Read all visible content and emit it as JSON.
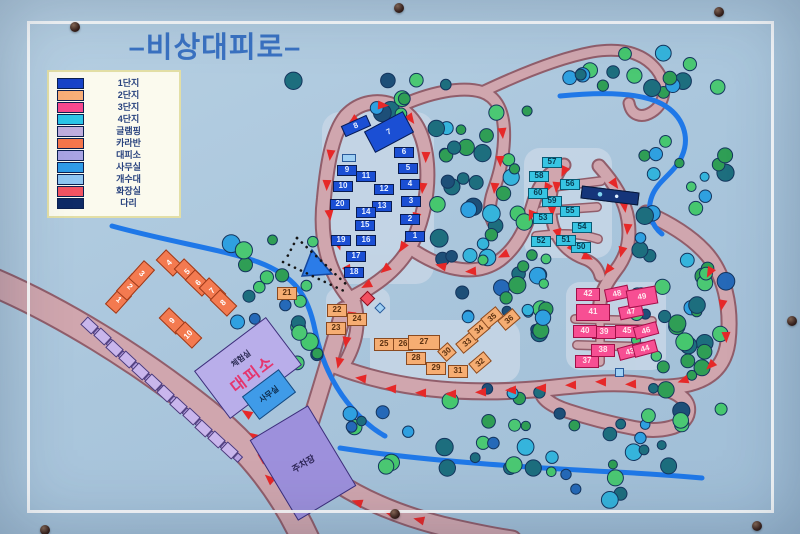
{
  "sign": {
    "title": "–비상대피로–"
  },
  "legend": {
    "items": [
      {
        "label": "1단지",
        "color": "#1843c8"
      },
      {
        "label": "2단지",
        "color": "#f9ae78"
      },
      {
        "label": "3단지",
        "color": "#f8488e"
      },
      {
        "label": "4단지",
        "color": "#2cc5e8"
      },
      {
        "label": "글램핑",
        "color": "#c0aede"
      },
      {
        "label": "카라반",
        "color": "#f5764c"
      },
      {
        "label": "대피소",
        "color": "#a9a4e4"
      },
      {
        "label": "사무실",
        "color": "#2f9ce8"
      },
      {
        "label": "개수대",
        "color": "#8fc6f2"
      },
      {
        "label": "화장실",
        "color": "#f25462"
      },
      {
        "label": "다리",
        "color": "#0e2a66"
      }
    ]
  },
  "map": {
    "facilities": {
      "shelter": {
        "room_label": "체험실",
        "label": "대피소"
      },
      "office": {
        "label": "사무실"
      },
      "parking": {
        "label": "주차장"
      }
    },
    "glamping": {
      "count": 12
    },
    "zones": [
      {
        "id": "z1",
        "legend_label": "1단지",
        "fill": "#1b4fd4",
        "text_color": "#e8f0ff",
        "border": "#0a1c50",
        "bw": 20,
        "bh": 11,
        "buildings": [
          {
            "n": 1,
            "x": 415,
            "y": 236
          },
          {
            "n": 2,
            "x": 410,
            "y": 219
          },
          {
            "n": 3,
            "x": 411,
            "y": 201
          },
          {
            "n": 4,
            "x": 410,
            "y": 184
          },
          {
            "n": 5,
            "x": 408,
            "y": 168
          },
          {
            "n": 6,
            "x": 404,
            "y": 152
          },
          {
            "n": 7,
            "x": 389,
            "y": 132,
            "w": 44,
            "h": 24,
            "r": -28
          },
          {
            "n": 8,
            "x": 356,
            "y": 126,
            "w": 28,
            "h": 12,
            "r": -24
          },
          {
            "n": 9,
            "x": 347,
            "y": 170
          },
          {
            "n": 10,
            "x": 343,
            "y": 186
          },
          {
            "n": 11,
            "x": 366,
            "y": 176
          },
          {
            "n": 12,
            "x": 384,
            "y": 189
          },
          {
            "n": 13,
            "x": 382,
            "y": 206
          },
          {
            "n": 14,
            "x": 366,
            "y": 212
          },
          {
            "n": 15,
            "x": 365,
            "y": 225
          },
          {
            "n": 16,
            "x": 366,
            "y": 240
          },
          {
            "n": 17,
            "x": 356,
            "y": 256
          },
          {
            "n": 18,
            "x": 354,
            "y": 272
          },
          {
            "n": 19,
            "x": 341,
            "y": 240
          },
          {
            "n": 20,
            "x": 340,
            "y": 204
          }
        ]
      },
      {
        "id": "z2",
        "legend_label": "2단지",
        "fill": "#f6ad72",
        "text_color": "#5a3010",
        "border": "#8a4a20",
        "bw": 20,
        "bh": 13,
        "buildings": [
          {
            "n": 21,
            "x": 287,
            "y": 293
          },
          {
            "n": 22,
            "x": 337,
            "y": 310
          },
          {
            "n": 23,
            "x": 336,
            "y": 328
          },
          {
            "n": 24,
            "x": 357,
            "y": 319
          },
          {
            "n": 25,
            "x": 384,
            "y": 344
          },
          {
            "n": 26,
            "x": 403,
            "y": 344
          },
          {
            "n": 27,
            "x": 424,
            "y": 342,
            "w": 32,
            "h": 15
          },
          {
            "n": 28,
            "x": 416,
            "y": 358
          },
          {
            "n": 29,
            "x": 436,
            "y": 368
          },
          {
            "n": 30,
            "x": 447,
            "y": 352,
            "w": 14,
            "h": 14,
            "r": -42
          },
          {
            "n": 31,
            "x": 458,
            "y": 371
          },
          {
            "n": 32,
            "x": 480,
            "y": 362,
            "r": -40
          },
          {
            "n": 33,
            "x": 467,
            "y": 342,
            "r": -40
          },
          {
            "n": 34,
            "x": 479,
            "y": 329,
            "r": -40
          },
          {
            "n": 35,
            "x": 492,
            "y": 317,
            "r": -40
          },
          {
            "n": 36,
            "x": 509,
            "y": 319,
            "r": -40
          }
        ]
      },
      {
        "id": "z3",
        "legend_label": "3단지",
        "fill": "#f74f93",
        "text_color": "#ffe6ee",
        "border": "#a01048",
        "bw": 24,
        "bh": 13,
        "buildings": [
          {
            "n": 37,
            "x": 587,
            "y": 361
          },
          {
            "n": 38,
            "x": 603,
            "y": 350
          },
          {
            "n": 39,
            "x": 604,
            "y": 332
          },
          {
            "n": 40,
            "x": 585,
            "y": 331
          },
          {
            "n": 41,
            "x": 593,
            "y": 312,
            "w": 34,
            "h": 17
          },
          {
            "n": 42,
            "x": 588,
            "y": 294
          },
          {
            "n": 43,
            "x": 630,
            "y": 351,
            "r": -15
          },
          {
            "n": 44,
            "x": 645,
            "y": 348,
            "r": -15
          },
          {
            "n": 45,
            "x": 627,
            "y": 331
          },
          {
            "n": 46,
            "x": 646,
            "y": 330,
            "r": -15
          },
          {
            "n": 47,
            "x": 631,
            "y": 311,
            "r": -12
          },
          {
            "n": 48,
            "x": 617,
            "y": 293,
            "r": -12
          },
          {
            "n": 49,
            "x": 642,
            "y": 297,
            "w": 30,
            "h": 18,
            "r": -10
          }
        ]
      },
      {
        "id": "z4",
        "legend_label": "4단지",
        "fill": "#37c5e3",
        "text_color": "#083a50",
        "border": "#0a5a74",
        "bw": 20,
        "bh": 11,
        "buildings": [
          {
            "n": 50,
            "x": 581,
            "y": 247
          },
          {
            "n": 51,
            "x": 566,
            "y": 240
          },
          {
            "n": 52,
            "x": 541,
            "y": 241
          },
          {
            "n": 53,
            "x": 543,
            "y": 218
          },
          {
            "n": 54,
            "x": 582,
            "y": 227
          },
          {
            "n": 55,
            "x": 570,
            "y": 211
          },
          {
            "n": 56,
            "x": 570,
            "y": 184
          },
          {
            "n": 57,
            "x": 552,
            "y": 162
          },
          {
            "n": 58,
            "x": 539,
            "y": 176
          },
          {
            "n": 59,
            "x": 552,
            "y": 201
          },
          {
            "n": 60,
            "x": 538,
            "y": 193
          }
        ]
      },
      {
        "id": "caravan",
        "legend_label": "카라반",
        "fill": "#f37a50",
        "text_color": "#ffffff",
        "border": "#9c3818",
        "bw": 15,
        "bh": 24,
        "buildings": [
          {
            "n": 1,
            "x": 118,
            "y": 300,
            "r": 42
          },
          {
            "n": 2,
            "x": 129,
            "y": 287,
            "r": 42
          },
          {
            "n": 3,
            "x": 141,
            "y": 274,
            "r": 42
          },
          {
            "n": 4,
            "x": 169,
            "y": 263,
            "r": -46
          },
          {
            "n": 5,
            "x": 187,
            "y": 272,
            "r": -46
          },
          {
            "n": 6,
            "x": 198,
            "y": 283,
            "r": -46
          },
          {
            "n": 7,
            "x": 212,
            "y": 291,
            "r": -46
          },
          {
            "n": 8,
            "x": 223,
            "y": 303,
            "r": -46
          },
          {
            "n": 9,
            "x": 172,
            "y": 321,
            "r": -46
          },
          {
            "n": 10,
            "x": 188,
            "y": 335,
            "r": -46
          }
        ]
      }
    ]
  }
}
